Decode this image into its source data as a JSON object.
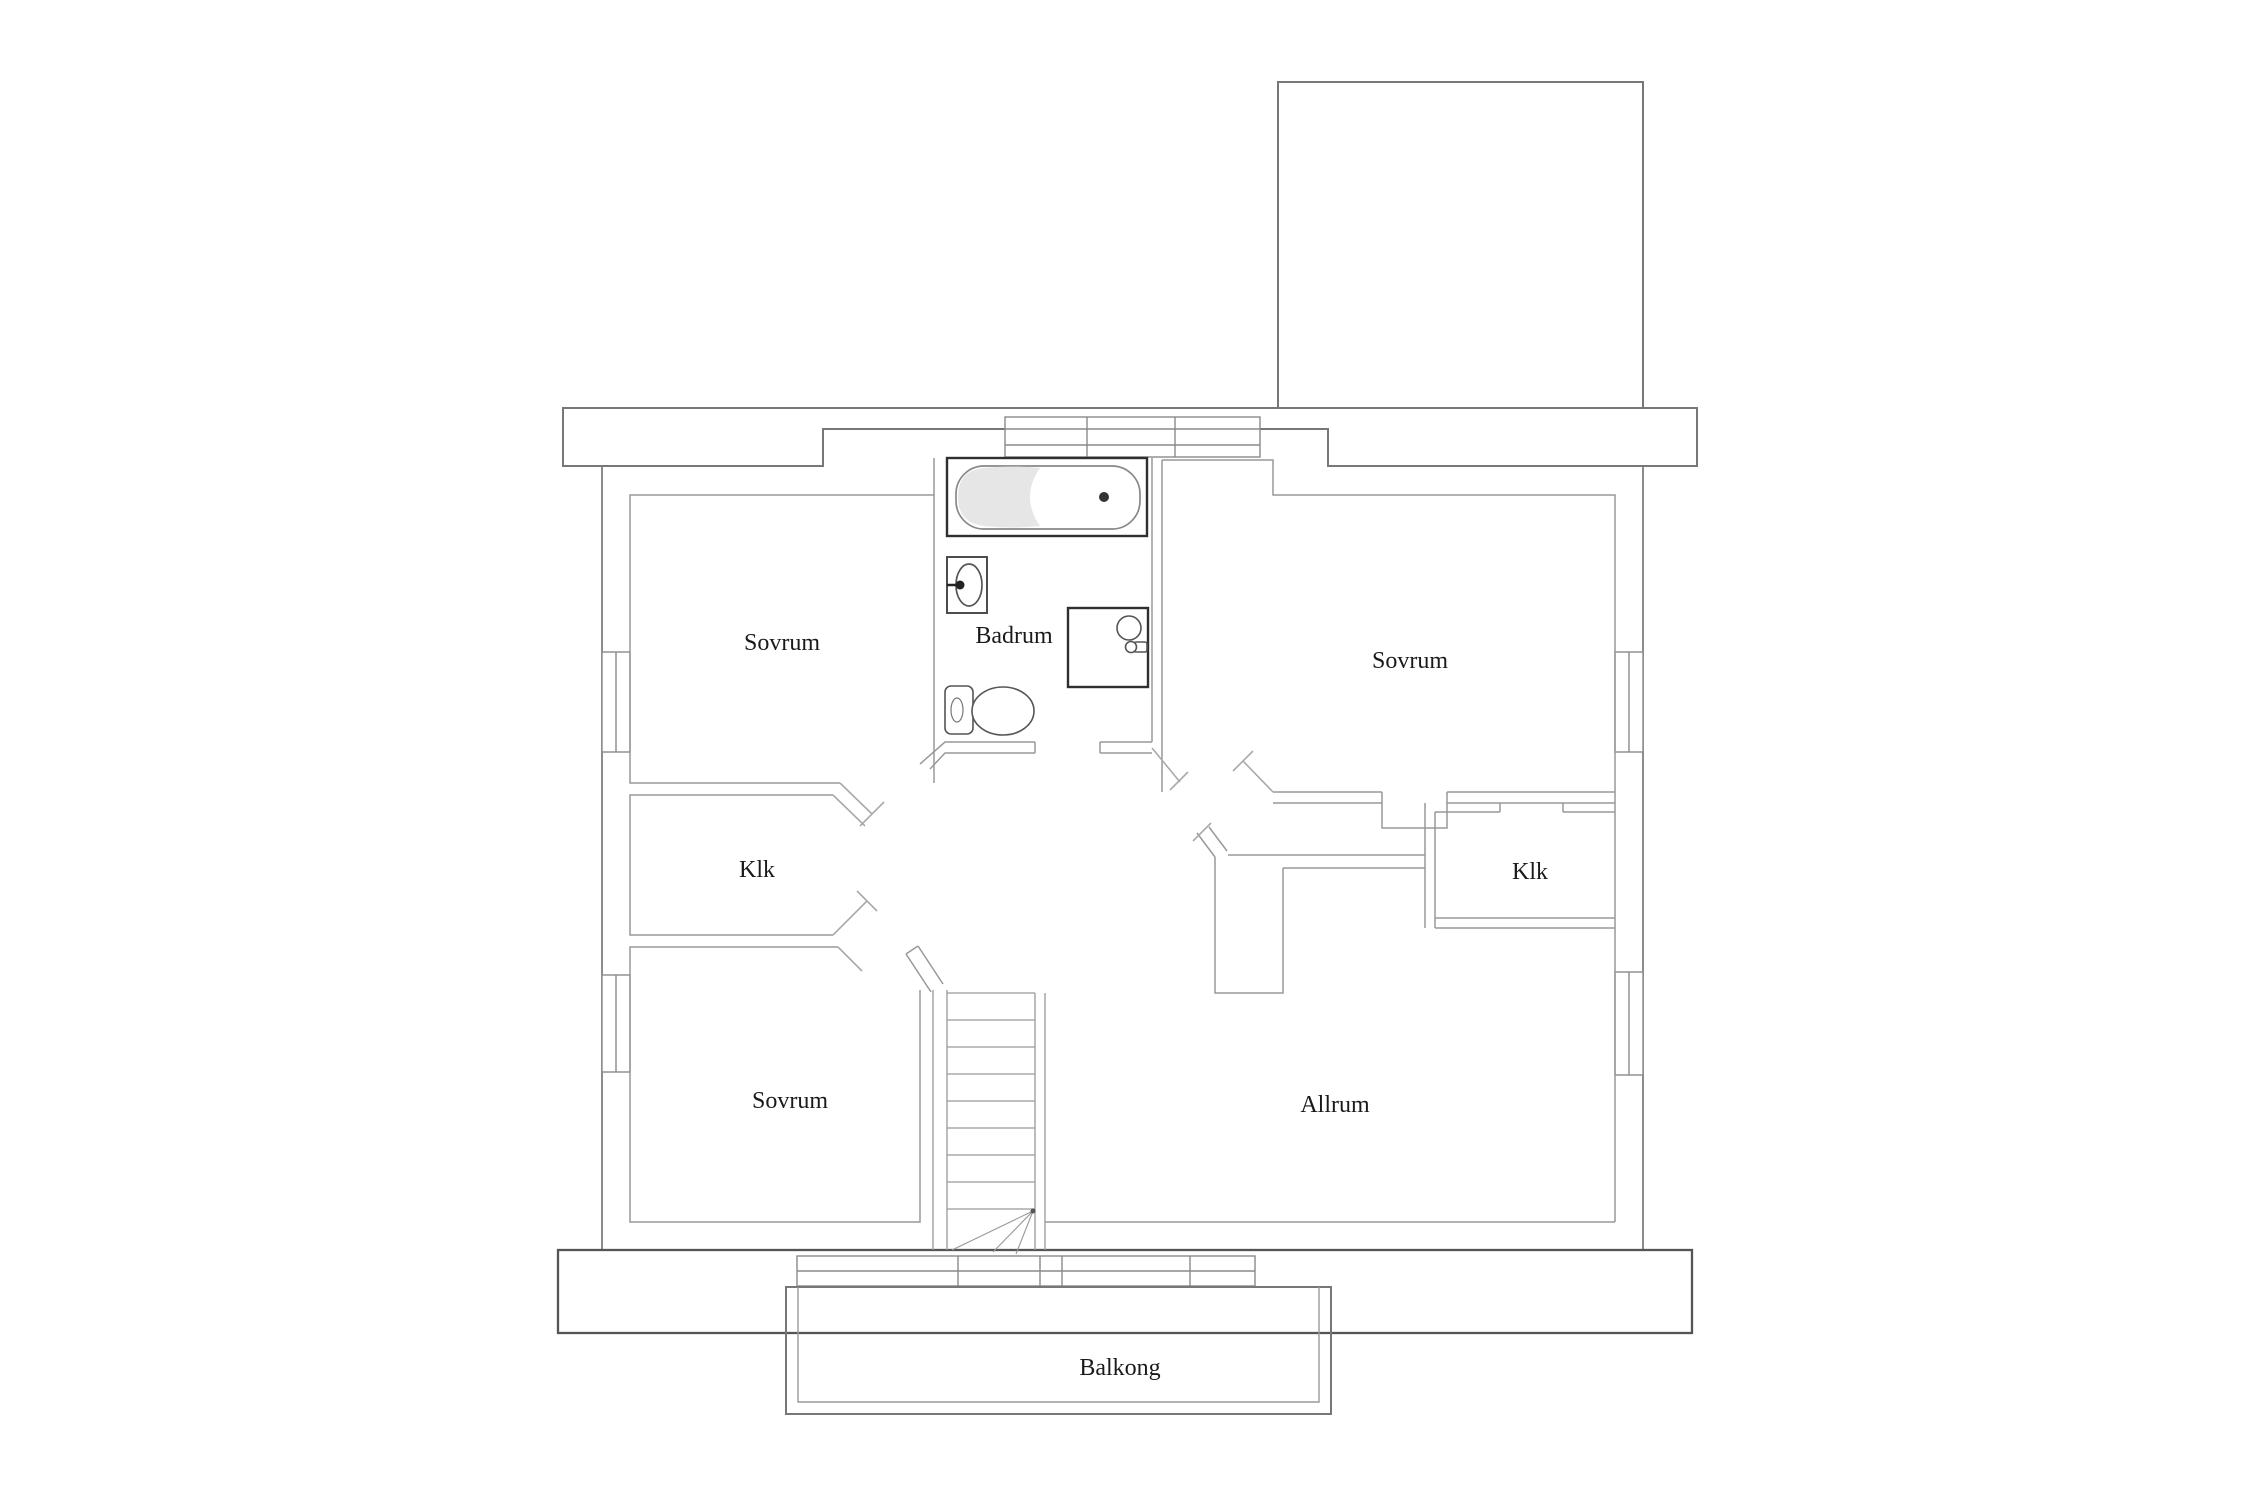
{
  "floorplan": {
    "rooms": [
      {
        "id": "sovrum-top-left",
        "label": "Sovrum"
      },
      {
        "id": "badrum",
        "label": "Badrum"
      },
      {
        "id": "sovrum-right",
        "label": "Sovrum"
      },
      {
        "id": "klk-left",
        "label": "Klk"
      },
      {
        "id": "klk-right",
        "label": "Klk"
      },
      {
        "id": "sovrum-bottom-left",
        "label": "Sovrum"
      },
      {
        "id": "allrum",
        "label": "Allrum"
      },
      {
        "id": "balkong",
        "label": "Balkong"
      }
    ],
    "fixtures": [
      "bathtub-icon",
      "sink-icon",
      "shower-icon",
      "toilet-icon",
      "stairs-icon"
    ],
    "colors": {
      "background": "#ffffff",
      "wall": "#8a8a8a",
      "wall_dark": "#555555",
      "fixture": "#2f2f2f",
      "label": "#1a1a1a",
      "tub_shading": "#e3e3e3"
    }
  }
}
